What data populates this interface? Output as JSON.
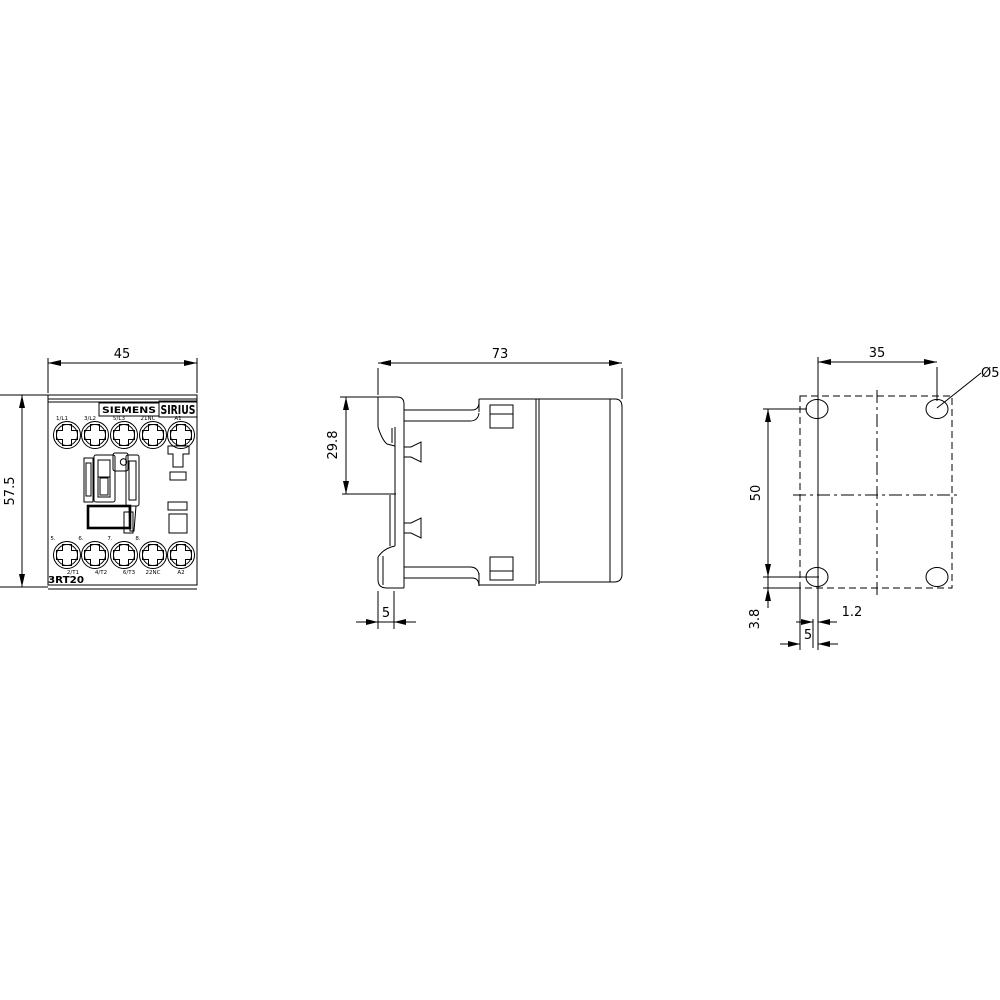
{
  "colors": {
    "line": "#000000",
    "background": "#ffffff"
  },
  "front": {
    "dim_width": "45",
    "dim_height": "57.5",
    "brand": "SIEMENS",
    "series": "SIRIUS",
    "model": "3RT20",
    "terminals_top": [
      "1/L1",
      "3/L2",
      "5/L3",
      "21NC",
      "A1"
    ],
    "terminals_bottom": [
      "2/T1",
      "4/T2",
      "6/T3",
      "22NC",
      "A2"
    ],
    "clamp_numbers": [
      "5.",
      "6.",
      "7.",
      "8."
    ]
  },
  "side": {
    "dim_depth": "73",
    "dim_rail_height": "29.8",
    "dim_foot_depth": "5"
  },
  "drill": {
    "dim_horizontal_spacing": "35",
    "dim_vertical_spacing": "50",
    "dim_bottom_offset": "3.8",
    "dim_center_offset": "1.2",
    "dim_edge_offset": "5",
    "hole_diameter": "Ø5"
  }
}
